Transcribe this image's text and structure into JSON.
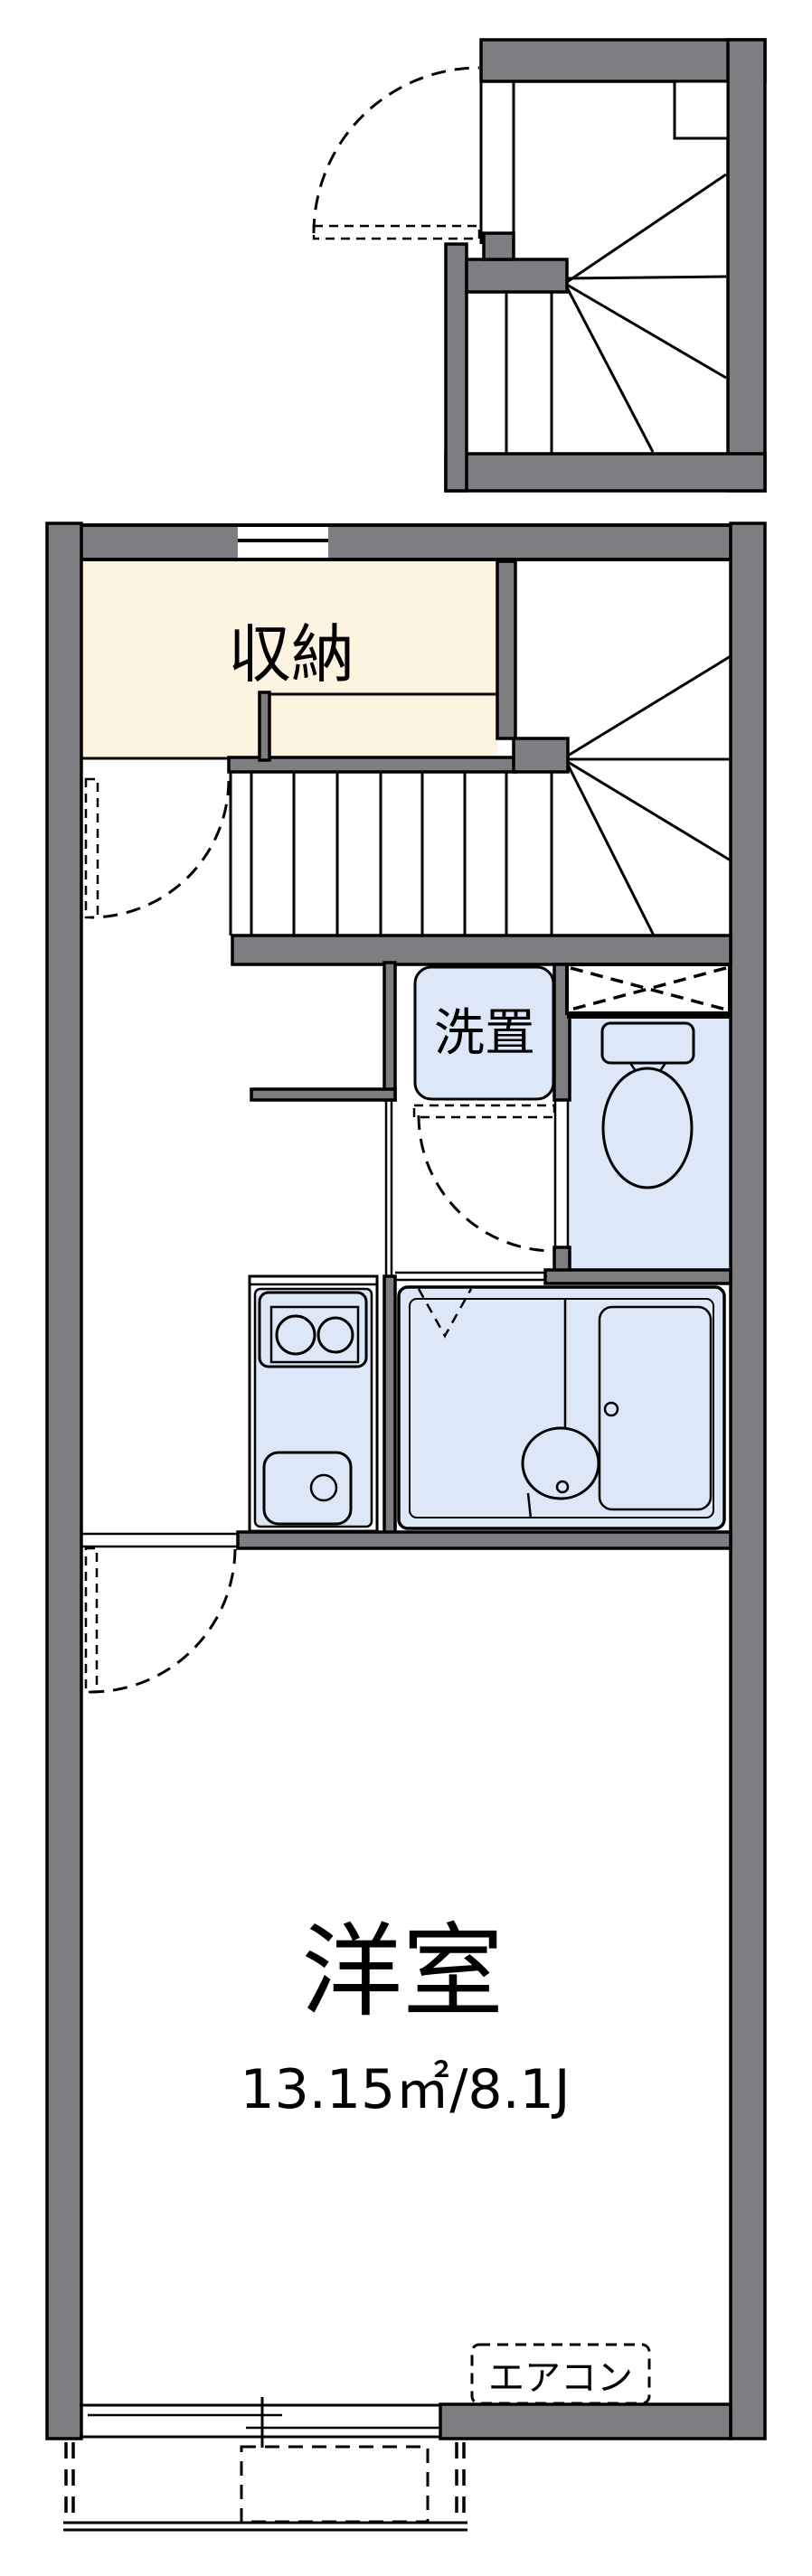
{
  "colors": {
    "wall": "#7d7d82",
    "line": "#000000",
    "background": "#ffffff",
    "fixture_blue": "#dce8f8",
    "storage_cream": "#fdf3e1"
  },
  "rooms": {
    "storage": {
      "label": "収納",
      "fill": "#fdf3e1"
    },
    "laundry": {
      "label": "洗置",
      "fill": "#dce8f8"
    },
    "toilet": {
      "fill": "#dce8f8"
    },
    "bathroom": {
      "fill": "#dce8f8"
    },
    "kitchen": {
      "fill": "#dce8f8"
    },
    "western_room": {
      "label": "洋室",
      "area_text": "13.15㎡/8.1J"
    },
    "air_conditioner": {
      "label": "エアコン"
    }
  }
}
